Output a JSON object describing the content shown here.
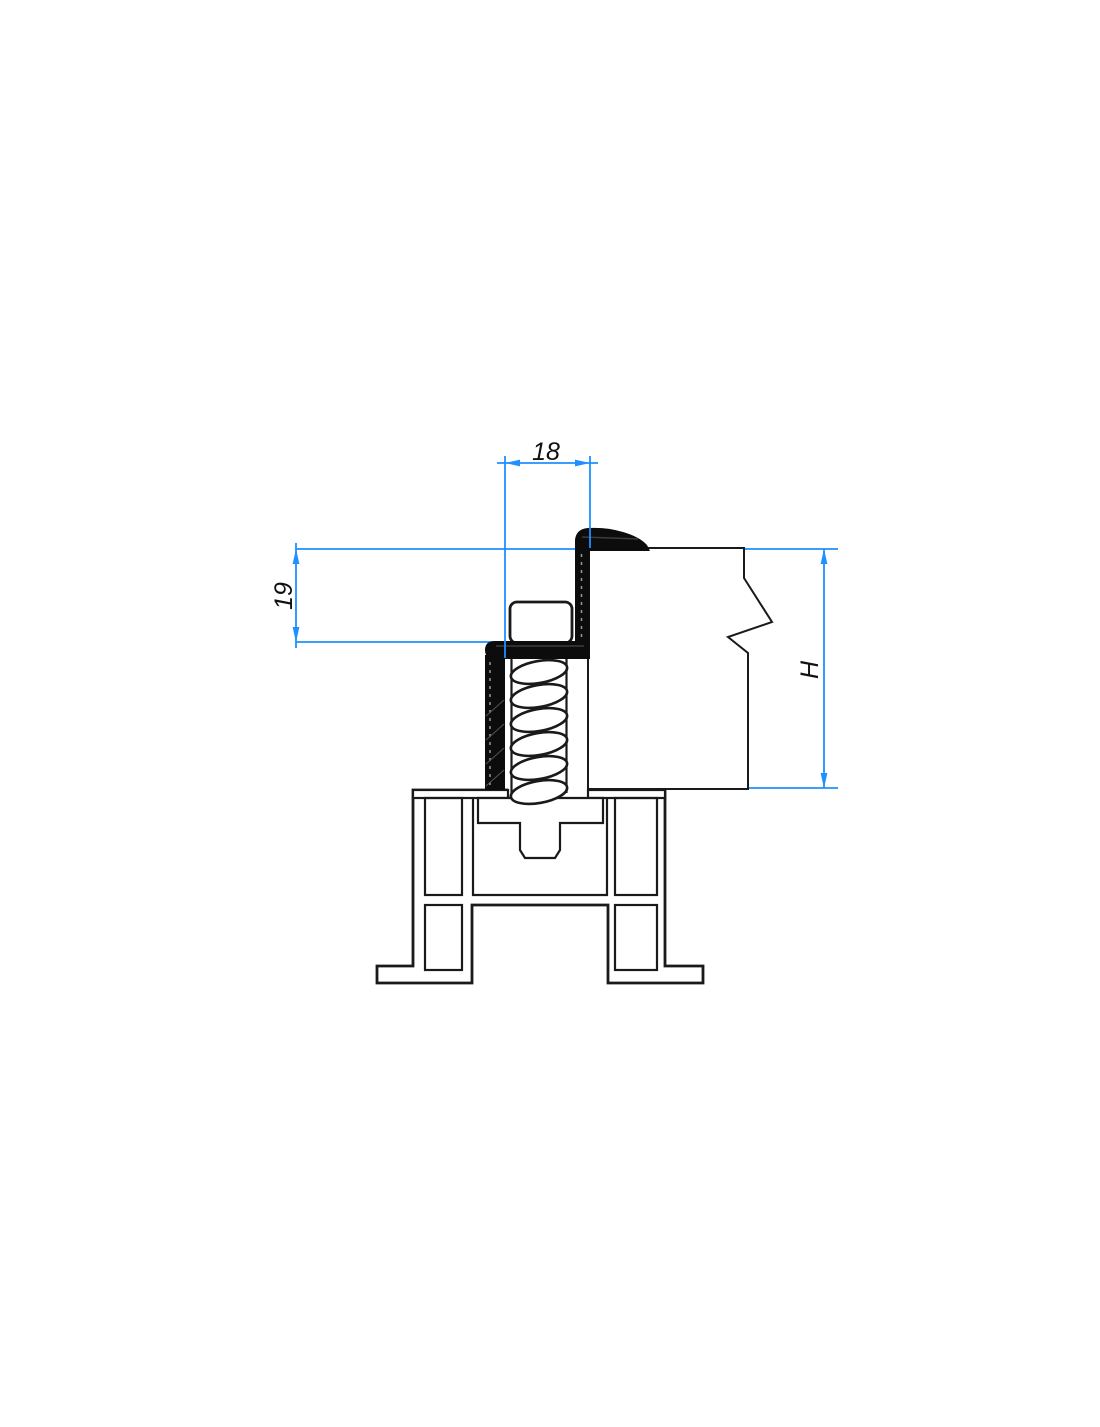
{
  "colors": {
    "dim": "#1E90FF",
    "ink": "#1a1a1a",
    "hatch": "#4f4f4f",
    "seal": "#0c0c0c"
  },
  "dimensions": {
    "top_width": "18",
    "left_height": "19",
    "right_height": "H"
  }
}
